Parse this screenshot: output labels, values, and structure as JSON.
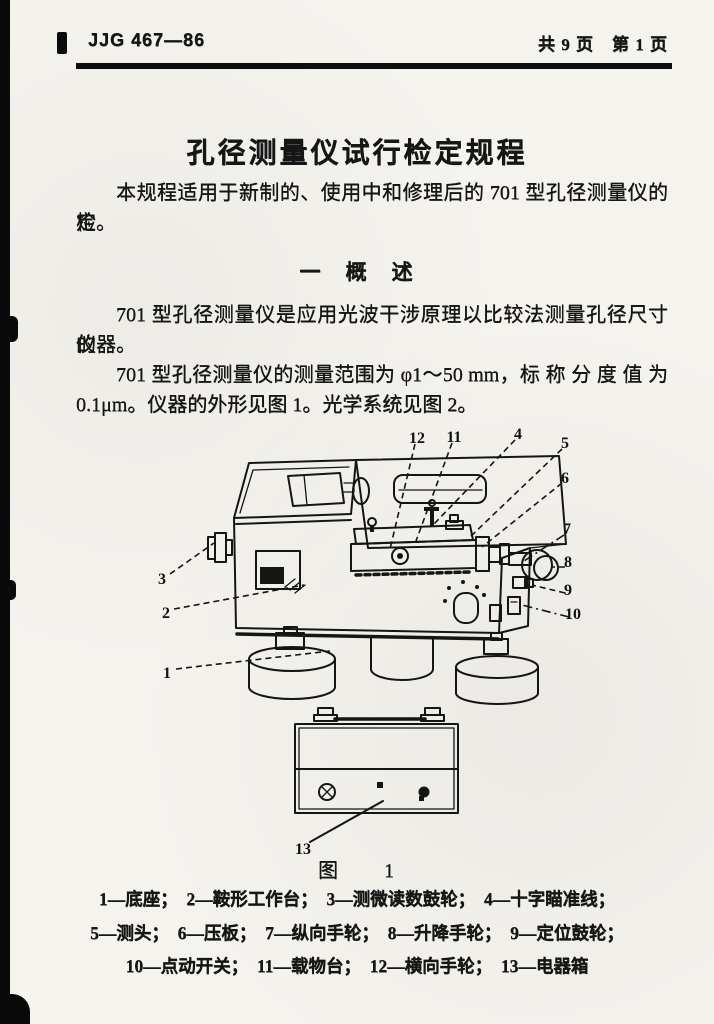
{
  "header": {
    "doc_number": "JJG 467—86",
    "page_info": "共 9 页　第 1 页"
  },
  "title": "孔径测量仪试行检定规程",
  "paragraphs": {
    "p1": [
      "本规程适用于新制的、使用中和修理后的 701 型孔径测量仪的检",
      "定。"
    ],
    "section_heading": "一　概　述",
    "p2": [
      "701 型孔径测量仪是应用光波干涉原理以比较法测量孔径尺寸的",
      "仪器。"
    ],
    "p3": [
      "701 型孔径测量仪的测量范围为 φ1～50 mm，标 称 分 度 值 为",
      "0.1μm。仪器的外形见图 1。光学系统见图 2。"
    ]
  },
  "figure": {
    "caption": "图　　1",
    "callouts": {
      "c1": "1",
      "c2": "2",
      "c3": "3",
      "c4": "4",
      "c5": "5",
      "c6": "6",
      "c7": "7",
      "c8": "8",
      "c9": "9",
      "c10": "10",
      "c11": "11",
      "c12": "12",
      "c13": "13"
    },
    "legend": [
      "1—底座；　2—鞍形工作台；　3—测微读数鼓轮；　4—十字瞄准线；",
      "5—测头；　6—压板；　7—纵向手轮；　8—升降手轮；　9—定位鼓轮；",
      "10—点动开关；　11—载物台；　12—横向手轮；　13—电器箱"
    ]
  }
}
